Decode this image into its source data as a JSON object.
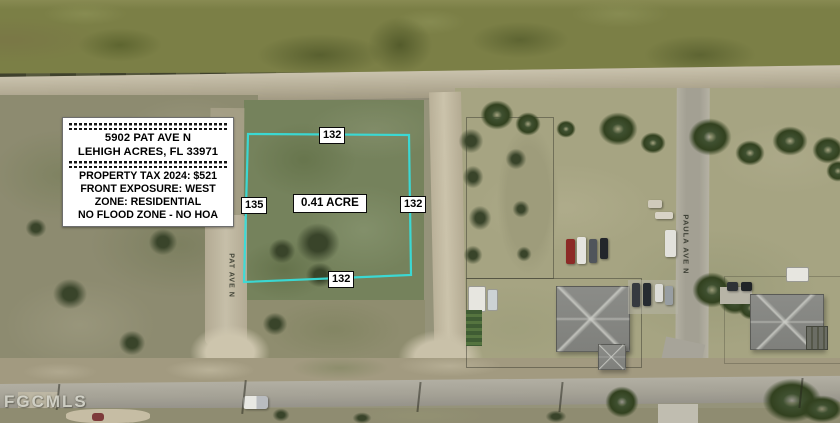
{
  "annotations": {
    "info_box": {
      "address_line1": "5902 PAT AVE N",
      "address_line2": "LEHIGH ACRES, FL 33971",
      "detail_lines": [
        "PROPERTY TAX 2024: $521",
        "FRONT EXPOSURE: WEST",
        "ZONE: RESIDENTIAL",
        "NO FLOOD ZONE - NO HOA"
      ]
    },
    "lot": {
      "area_label": "0.41 ACRE",
      "dimensions": {
        "top": "132",
        "left": "135",
        "right": "132",
        "bottom": "132"
      },
      "boundary_color": "#38dcd9",
      "boundary_points": "248,134 409,135 411,275 244,282"
    },
    "streets": {
      "left_vertical": "PAT AVE N",
      "right_vertical": "PAULA AVE N"
    },
    "watermark": "FGCMLS"
  },
  "colors": {
    "boundary_cyan": "#38dcd9",
    "canal_green": "#7b7f46",
    "dirt_road_tan": "#c1b8a0",
    "paved_road_gray": "#a5a296",
    "grass_right": "#a6a482",
    "scrub_left": "#8d8b70",
    "lot_green": "#75825c",
    "roof_gray": "#858682",
    "label_bg": "#ffffff",
    "label_text": "#000000"
  }
}
